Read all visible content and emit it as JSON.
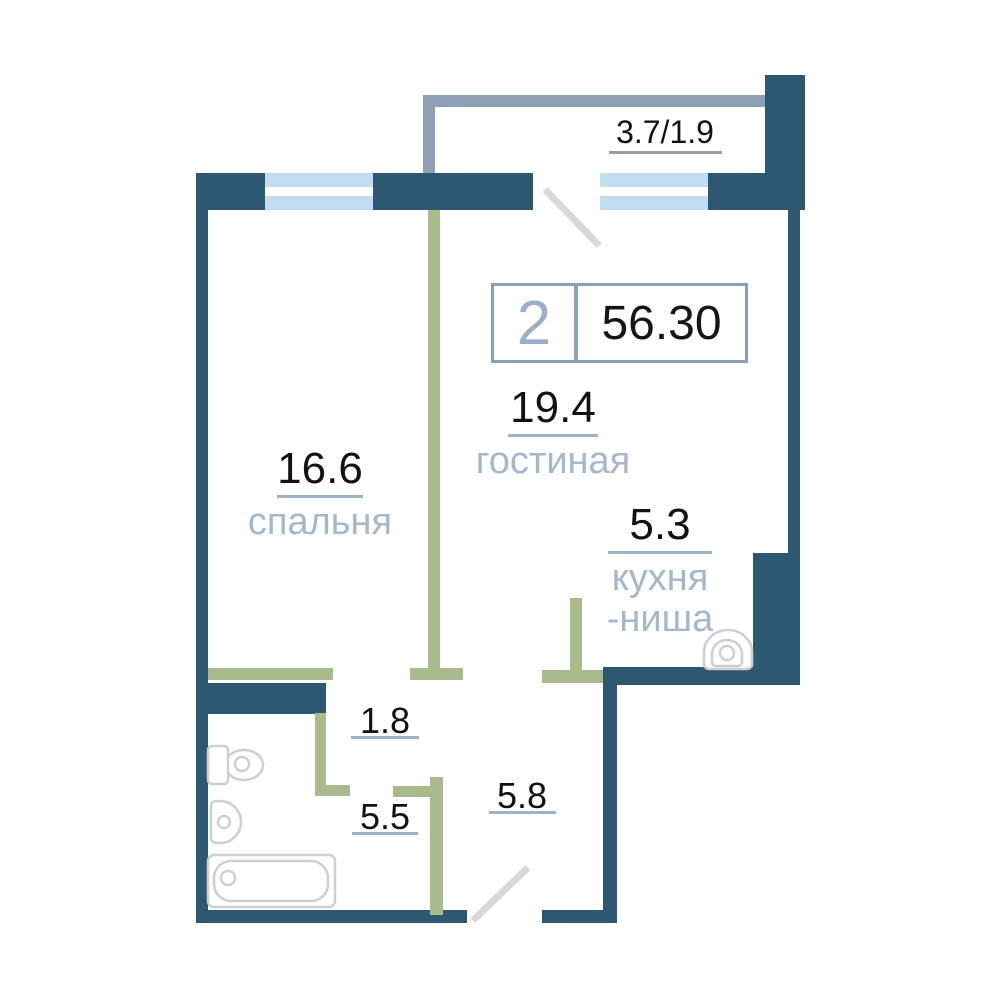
{
  "plan": {
    "type": "apartment-floorplan",
    "badge": {
      "rooms_count": "2",
      "total_area": "56.30"
    },
    "rooms": {
      "living": {
        "area": "19.4",
        "name": "гостиная"
      },
      "bedroom": {
        "area": "16.6",
        "name": "спальня"
      },
      "kitchen": {
        "area": "5.3",
        "name_line1": "кухня",
        "name_line2": "-ниша"
      },
      "closet": {
        "area": "1.8"
      },
      "bathroom": {
        "area": "5.5"
      },
      "hallway": {
        "area": "5.8"
      },
      "balcony": {
        "area": "3.7/1.9"
      }
    },
    "fixtures": [
      "toilet-icon",
      "bathroom-sink-icon",
      "bathtub-icon",
      "kitchen-sink-icon"
    ],
    "colors": {
      "wall_dark": "#2d5872",
      "wall_partition_olive": "#a9ba8c",
      "balcony_outline": "#8ca1b6",
      "window_blue": "#c2dcf2",
      "room_name_text": "#a5b8c9",
      "area_number_text": "#121212",
      "underline": "#9db4c8",
      "door_swing": "#d8d8d8",
      "fixture_outline": "#cfcfcf",
      "badge_border": "#8ba1b5",
      "badge_rooms_text": "#9cb0c5"
    }
  }
}
